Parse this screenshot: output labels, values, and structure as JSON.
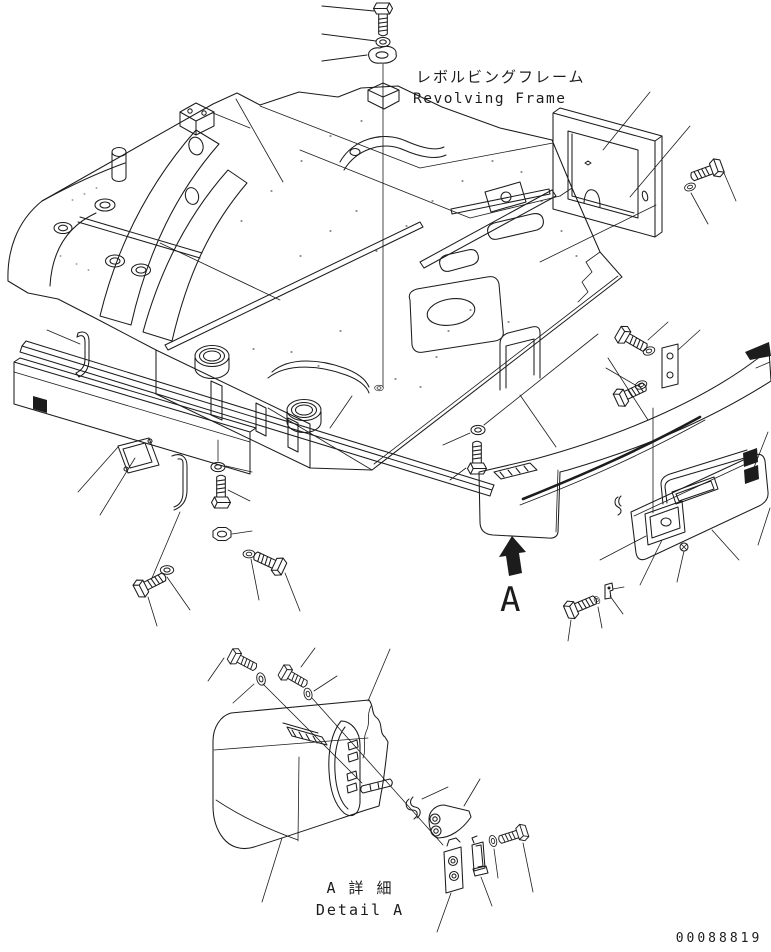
{
  "colors": {
    "ink": "#1c1c1c",
    "background": "#ffffff"
  },
  "title": {
    "jp": "レボルビングフレーム",
    "en": "Revolving Frame"
  },
  "detail_caption": {
    "jp": "A 詳 細",
    "en": "Detail A"
  },
  "view_marker_label": "A",
  "drawing_number": "00088819"
}
